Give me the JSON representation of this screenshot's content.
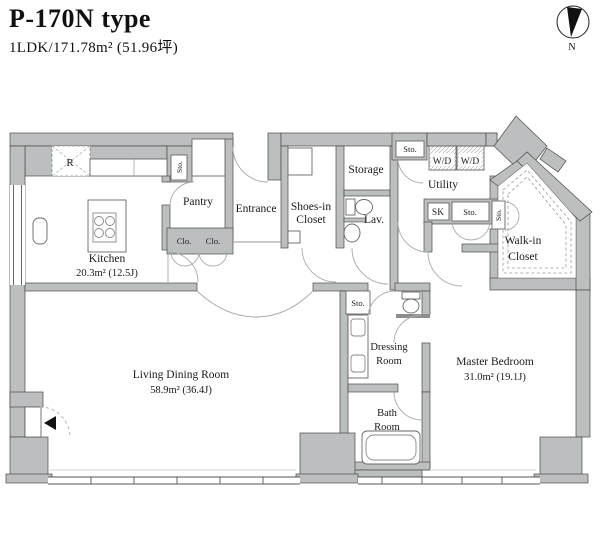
{
  "header": {
    "title": "P-170N type",
    "subtitle": "1LDK/171.78m² (51.96坪)"
  },
  "compass": {
    "label": "N"
  },
  "colors": {
    "wall_fill": "#bcbfbf",
    "wall_stroke": "#4a4a4a",
    "door_arc": "#aaaaaa",
    "text": "#1a1a1a"
  },
  "rooms": {
    "kitchen": {
      "name": "Kitchen",
      "area": "20.3m² (12.5J)"
    },
    "living_dining": {
      "name": "Living Dining Room",
      "area": "58.9m² (36.4J)"
    },
    "master_bedroom": {
      "name": "Master Bedroom",
      "area": "31.0m² (19.1J)"
    },
    "entrance": {
      "name": "Entrance"
    },
    "pantry": {
      "name": "Pantry"
    },
    "shoes_in_closet": {
      "line1": "Shoes-in",
      "line2": "Closet"
    },
    "storage": {
      "name": "Storage"
    },
    "lavatory": {
      "name": "Lav."
    },
    "utility": {
      "name": "Utility"
    },
    "walk_in_closet": {
      "line1": "Walk-in",
      "line2": "Closet"
    },
    "dressing_room": {
      "line1": "Dressing",
      "line2": "Room"
    },
    "bath_room": {
      "line1": "Bath",
      "line2": "Room"
    }
  },
  "small_labels": {
    "refrigerator": "R",
    "closet1": "Clo.",
    "closet2": "Clo.",
    "sto_pantry": "Sto.",
    "sto_top": "Sto.",
    "sto_utility": "Sto.",
    "sto_wic": "Sto.",
    "sto_dressing": "Sto.",
    "washer_dryer1": "W/D",
    "washer_dryer2": "W/D",
    "sink": "SK"
  }
}
